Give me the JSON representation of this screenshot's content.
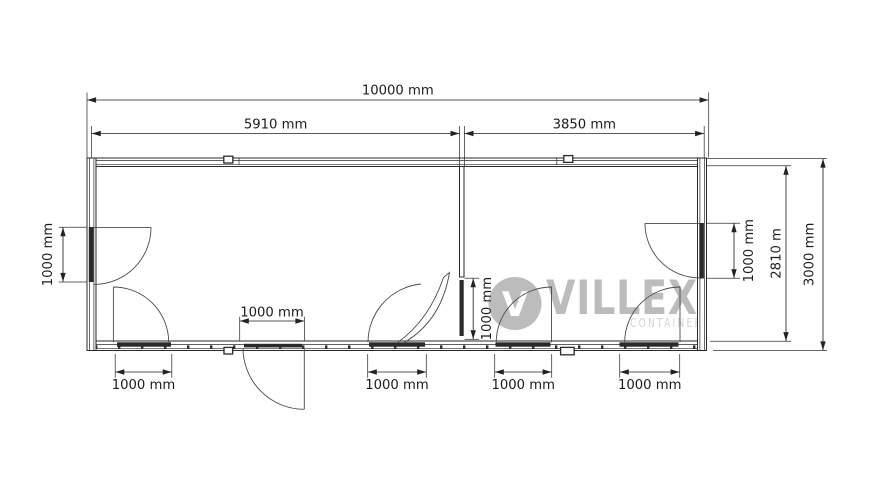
{
  "watermark": {
    "letter": "V",
    "brand": "VILLEX",
    "subtitle": "CONTAINER"
  },
  "labels": {
    "overall_width": "10000 mm",
    "section_left": "5910 mm",
    "section_right": "3850 mm",
    "depth_outer": "3000 mm",
    "depth_inner": "2810 m",
    "door_left_wall": "1000 mm",
    "door_right_wall": "1000 mm",
    "door_partition": "1000 mm",
    "door_front_left": "1000 mm",
    "door_front_mid": "1000 mm",
    "door_front_room1_right": "1000 mm",
    "door_front_room2_left": "1000 mm",
    "door_front_room2_right": "1000 mm"
  },
  "colors": {
    "line": "#2a2a2a",
    "dim_text": "#1c1c1c",
    "watermark": "#bcbcbc",
    "watermark_light": "#d2d2d2"
  }
}
